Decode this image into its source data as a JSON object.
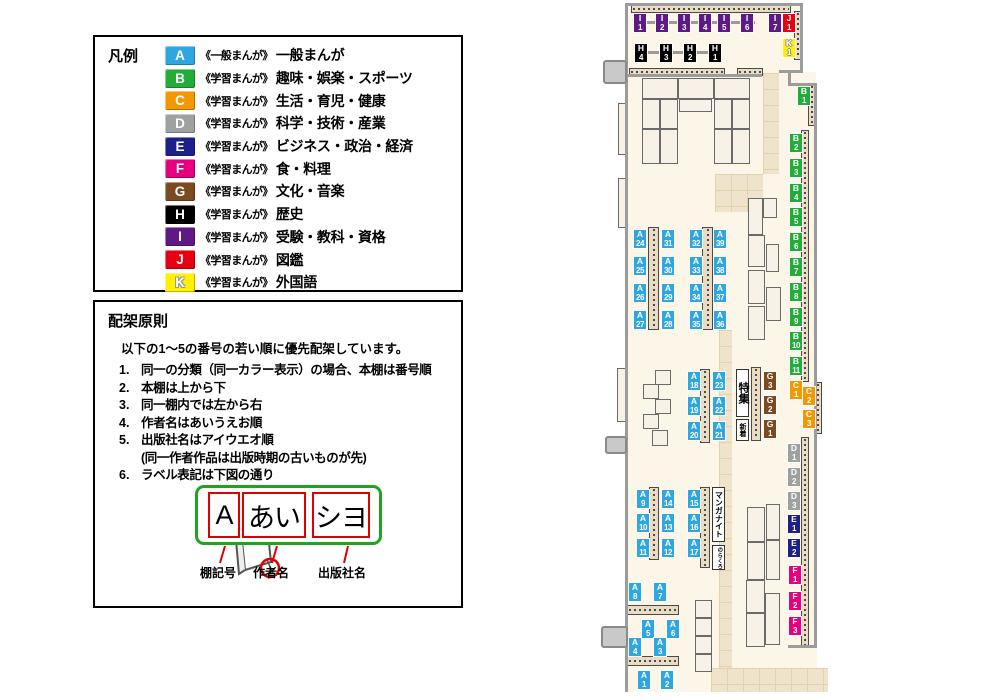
{
  "legend": {
    "title": "凡例",
    "items": [
      {
        "code": "A",
        "type": "《一般まんが》",
        "category": "一般まんが"
      },
      {
        "code": "B",
        "type": "《学習まんが》",
        "category": "趣味・娯楽・スポーツ"
      },
      {
        "code": "C",
        "type": "《学習まんが》",
        "category": "生活・育児・健康"
      },
      {
        "code": "D",
        "type": "《学習まんが》",
        "category": "科学・技術・産業"
      },
      {
        "code": "E",
        "type": "《学習まんが》",
        "category": "ビジネス・政治・経済"
      },
      {
        "code": "F",
        "type": "《学習まんが》",
        "category": "食・料理"
      },
      {
        "code": "G",
        "type": "《学習まんが》",
        "category": "文化・音楽"
      },
      {
        "code": "H",
        "type": "《学習まんが》",
        "category": "歴史"
      },
      {
        "code": "I",
        "type": "《学習まんが》",
        "category": "受験・教科・資格"
      },
      {
        "code": "J",
        "type": "《学習まんが》",
        "category": "図鑑"
      },
      {
        "code": "K",
        "type": "《学習まんが》",
        "category": "外国語"
      }
    ]
  },
  "principles": {
    "title": "配架原則",
    "intro": "以下の1〜5の番号の若い順に優先配架しています。",
    "rules": [
      {
        "num": "1.",
        "text": "同一の分類（同一カラー表示）の場合、本棚は番号順"
      },
      {
        "num": "2.",
        "text": "本棚は上から下"
      },
      {
        "num": "3.",
        "text": "同一棚内では左から右"
      },
      {
        "num": "4.",
        "text": "作者名はあいうえお順"
      },
      {
        "num": "5.",
        "text": "出版社名はアイウエオ順",
        "sub": "(同一作者作品は出版時期の古いものが先)"
      },
      {
        "num": "6.",
        "text": "ラベル表記は下図の通り"
      }
    ],
    "label_example": {
      "shelf_code": "A",
      "author": "あい",
      "publisher": "シヨ",
      "captions": [
        "棚記号",
        "作者名",
        "出版社名"
      ]
    }
  },
  "map": {
    "palette": {
      "A": "#2ea7e0",
      "B": "#22ac38",
      "C": "#f39800",
      "D": "#9fa0a0",
      "E": "#1d2088",
      "F": "#e4007f",
      "G": "#7b4a21",
      "H": "#000000",
      "I": "#5f1985",
      "J": "#e60012",
      "K": "#fff100"
    },
    "labels": [
      {
        "id": "I1",
        "code": "I",
        "num": "1",
        "x": 633,
        "y": 13
      },
      {
        "id": "I2",
        "code": "I",
        "num": "2",
        "x": 655,
        "y": 13
      },
      {
        "id": "I3",
        "code": "I",
        "num": "3",
        "x": 677,
        "y": 13
      },
      {
        "id": "I4",
        "code": "I",
        "num": "4",
        "x": 698,
        "y": 13
      },
      {
        "id": "I5",
        "code": "I",
        "num": "5",
        "x": 717,
        "y": 13
      },
      {
        "id": "I6",
        "code": "I",
        "num": "6",
        "x": 740,
        "y": 13
      },
      {
        "id": "I7",
        "code": "I",
        "num": "7",
        "x": 768,
        "y": 13
      },
      {
        "id": "J1",
        "code": "J",
        "num": "1",
        "x": 782,
        "y": 13
      },
      {
        "id": "K1",
        "code": "K",
        "num": "1",
        "x": 782,
        "y": 38
      },
      {
        "id": "H4",
        "code": "H",
        "num": "4",
        "x": 634,
        "y": 43
      },
      {
        "id": "H3",
        "code": "H",
        "num": "3",
        "x": 659,
        "y": 43
      },
      {
        "id": "H2",
        "code": "H",
        "num": "2",
        "x": 683,
        "y": 43
      },
      {
        "id": "H1",
        "code": "H",
        "num": "1",
        "x": 708,
        "y": 43
      },
      {
        "id": "B1",
        "code": "B",
        "num": "1",
        "x": 797,
        "y": 86
      },
      {
        "id": "B2",
        "code": "B",
        "num": "2",
        "x": 789,
        "y": 133
      },
      {
        "id": "B3",
        "code": "B",
        "num": "3",
        "x": 789,
        "y": 158
      },
      {
        "id": "B4",
        "code": "B",
        "num": "4",
        "x": 789,
        "y": 183
      },
      {
        "id": "B5",
        "code": "B",
        "num": "5",
        "x": 789,
        "y": 207
      },
      {
        "id": "B6",
        "code": "B",
        "num": "6",
        "x": 789,
        "y": 232
      },
      {
        "id": "B7",
        "code": "B",
        "num": "7",
        "x": 789,
        "y": 257
      },
      {
        "id": "B8",
        "code": "B",
        "num": "8",
        "x": 789,
        "y": 282
      },
      {
        "id": "B9",
        "code": "B",
        "num": "9",
        "x": 789,
        "y": 307
      },
      {
        "id": "B10",
        "code": "B",
        "num": "10",
        "x": 789,
        "y": 331
      },
      {
        "id": "B11",
        "code": "B",
        "num": "11",
        "x": 789,
        "y": 356
      },
      {
        "id": "C1",
        "code": "C",
        "num": "1",
        "x": 789,
        "y": 380
      },
      {
        "id": "C2",
        "code": "C",
        "num": "2",
        "x": 802,
        "y": 386
      },
      {
        "id": "C3",
        "code": "C",
        "num": "3",
        "x": 802,
        "y": 409
      },
      {
        "id": "D1",
        "code": "D",
        "num": "1",
        "x": 787,
        "y": 443
      },
      {
        "id": "D2",
        "code": "D",
        "num": "2",
        "x": 787,
        "y": 467
      },
      {
        "id": "D3",
        "code": "D",
        "num": "3",
        "x": 787,
        "y": 491
      },
      {
        "id": "E1",
        "code": "E",
        "num": "1",
        "x": 787,
        "y": 514
      },
      {
        "id": "E2",
        "code": "E",
        "num": "2",
        "x": 787,
        "y": 538
      },
      {
        "id": "F1",
        "code": "F",
        "num": "1",
        "x": 788,
        "y": 565
      },
      {
        "id": "F2",
        "code": "F",
        "num": "2",
        "x": 788,
        "y": 591
      },
      {
        "id": "F3",
        "code": "F",
        "num": "3",
        "x": 788,
        "y": 616
      },
      {
        "id": "G3",
        "code": "G",
        "num": "3",
        "x": 763,
        "y": 371
      },
      {
        "id": "G2",
        "code": "G",
        "num": "2",
        "x": 763,
        "y": 395
      },
      {
        "id": "G1",
        "code": "G",
        "num": "1",
        "x": 763,
        "y": 419
      },
      {
        "id": "A24",
        "code": "A",
        "num": "24",
        "x": 633,
        "y": 229
      },
      {
        "id": "A25",
        "code": "A",
        "num": "25",
        "x": 633,
        "y": 256
      },
      {
        "id": "A26",
        "code": "A",
        "num": "26",
        "x": 633,
        "y": 283
      },
      {
        "id": "A27",
        "code": "A",
        "num": "27",
        "x": 633,
        "y": 310
      },
      {
        "id": "A31",
        "code": "A",
        "num": "31",
        "x": 661,
        "y": 229
      },
      {
        "id": "A30",
        "code": "A",
        "num": "30",
        "x": 661,
        "y": 256
      },
      {
        "id": "A29",
        "code": "A",
        "num": "29",
        "x": 661,
        "y": 283
      },
      {
        "id": "A28",
        "code": "A",
        "num": "28",
        "x": 661,
        "y": 310
      },
      {
        "id": "A32",
        "code": "A",
        "num": "32",
        "x": 689,
        "y": 229
      },
      {
        "id": "A33",
        "code": "A",
        "num": "33",
        "x": 689,
        "y": 256
      },
      {
        "id": "A34",
        "code": "A",
        "num": "34",
        "x": 689,
        "y": 283
      },
      {
        "id": "A35",
        "code": "A",
        "num": "35",
        "x": 689,
        "y": 310
      },
      {
        "id": "A39",
        "code": "A",
        "num": "39",
        "x": 713,
        "y": 229
      },
      {
        "id": "A38",
        "code": "A",
        "num": "38",
        "x": 713,
        "y": 256
      },
      {
        "id": "A37",
        "code": "A",
        "num": "37",
        "x": 713,
        "y": 283
      },
      {
        "id": "A36",
        "code": "A",
        "num": "36",
        "x": 713,
        "y": 310
      },
      {
        "id": "A18",
        "code": "A",
        "num": "18",
        "x": 687,
        "y": 371
      },
      {
        "id": "A19",
        "code": "A",
        "num": "19",
        "x": 687,
        "y": 396
      },
      {
        "id": "A20",
        "code": "A",
        "num": "20",
        "x": 687,
        "y": 421
      },
      {
        "id": "A23",
        "code": "A",
        "num": "23",
        "x": 712,
        "y": 371
      },
      {
        "id": "A22",
        "code": "A",
        "num": "22",
        "x": 712,
        "y": 396
      },
      {
        "id": "A21",
        "code": "A",
        "num": "21",
        "x": 712,
        "y": 421
      },
      {
        "id": "A9",
        "code": "A",
        "num": "9",
        "x": 636,
        "y": 489
      },
      {
        "id": "A10",
        "code": "A",
        "num": "10",
        "x": 636,
        "y": 513
      },
      {
        "id": "A11",
        "code": "A",
        "num": "11",
        "x": 636,
        "y": 538
      },
      {
        "id": "A14",
        "code": "A",
        "num": "14",
        "x": 661,
        "y": 489
      },
      {
        "id": "A13",
        "code": "A",
        "num": "13",
        "x": 661,
        "y": 513
      },
      {
        "id": "A12",
        "code": "A",
        "num": "12",
        "x": 661,
        "y": 538
      },
      {
        "id": "A15",
        "code": "A",
        "num": "15",
        "x": 687,
        "y": 489
      },
      {
        "id": "A16",
        "code": "A",
        "num": "16",
        "x": 687,
        "y": 513
      },
      {
        "id": "A17",
        "code": "A",
        "num": "17",
        "x": 687,
        "y": 538
      },
      {
        "id": "A8",
        "code": "A",
        "num": "8",
        "x": 628,
        "y": 582
      },
      {
        "id": "A7",
        "code": "A",
        "num": "7",
        "x": 653,
        "y": 582
      },
      {
        "id": "A5",
        "code": "A",
        "num": "5",
        "x": 641,
        "y": 619
      },
      {
        "id": "A6",
        "code": "A",
        "num": "6",
        "x": 666,
        "y": 619
      },
      {
        "id": "A4",
        "code": "A",
        "num": "4",
        "x": 628,
        "y": 637
      },
      {
        "id": "A3",
        "code": "A",
        "num": "3",
        "x": 653,
        "y": 637
      },
      {
        "id": "A1",
        "code": "A",
        "num": "1",
        "x": 637,
        "y": 670
      },
      {
        "id": "A2",
        "code": "A",
        "num": "2",
        "x": 660,
        "y": 670
      }
    ],
    "signs": [
      {
        "name": "special-feature-sign",
        "text": "特集",
        "x": 736,
        "y": 369,
        "w": 13,
        "h": 48
      },
      {
        "name": "new-arrivals-sign",
        "text": "新着",
        "x": 736,
        "y": 419,
        "w": 13,
        "h": 22
      },
      {
        "name": "manga-night-sign",
        "text": "マンガナイト",
        "x": 712,
        "y": 487,
        "w": 13,
        "h": 55
      },
      {
        "name": "norakuro-sign",
        "text": "のらくろ",
        "x": 712,
        "y": 545,
        "w": 13,
        "h": 25
      }
    ]
  }
}
